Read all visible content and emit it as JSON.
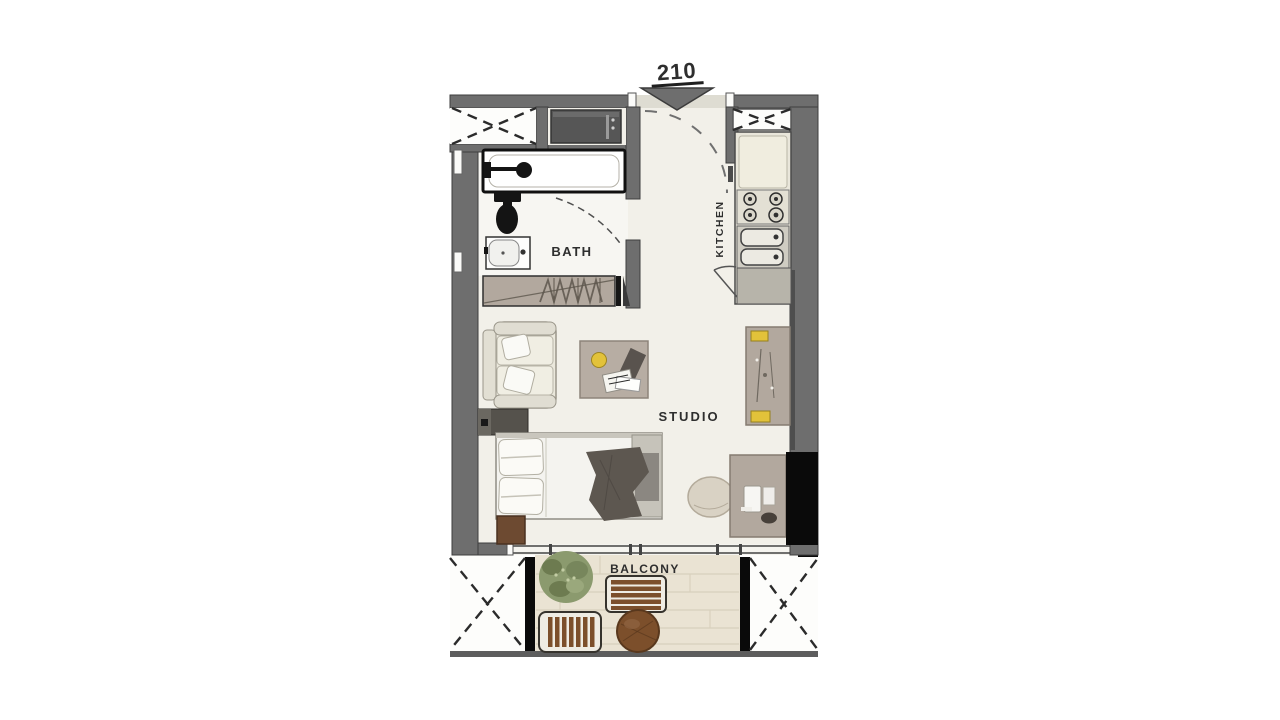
{
  "unit": {
    "number": "210"
  },
  "rooms": {
    "bath": "BATH",
    "kitchen": "KITCHEN",
    "studio": "STUDIO",
    "balcony": "BALCONY"
  },
  "furniture": [
    "washer-closet",
    "bathtub",
    "toilet",
    "bathroom-sink",
    "wardrobe",
    "kitchen-counter",
    "stove",
    "kitchen-sink",
    "sofa",
    "coffee-table",
    "desk",
    "tv-cabinet",
    "bed",
    "nightstand",
    "pouf",
    "dresser",
    "plant",
    "balcony-bench",
    "balcony-chair",
    "balcony-table"
  ],
  "colors": {
    "wall": "#6e6e6e",
    "wall_edge": "#3e3e3e",
    "floor": "#f2f0e9",
    "bath_floor": "#f7f6f2",
    "balcony_floor": "#eae3d3",
    "plank": "#d8d0bd",
    "threshold": "#dedcd2",
    "cream": "#ebe8dc",
    "outline": "#9a968a",
    "taupe": "#b2a89e",
    "wood": "#7c4f2b",
    "wood_dark": "#59381d",
    "appliance": "#565656",
    "ink": "#141414",
    "black": "#0a0a0a",
    "plant": "#8b9a6e",
    "plant_dark": "#6d7b50",
    "yellow": "#e2c23a",
    "label": "#2e2e2e",
    "counter": "#e9e6da",
    "throw": "#5d5750",
    "railing": "#5d5d5d",
    "dash": "#2b2b2b"
  }
}
